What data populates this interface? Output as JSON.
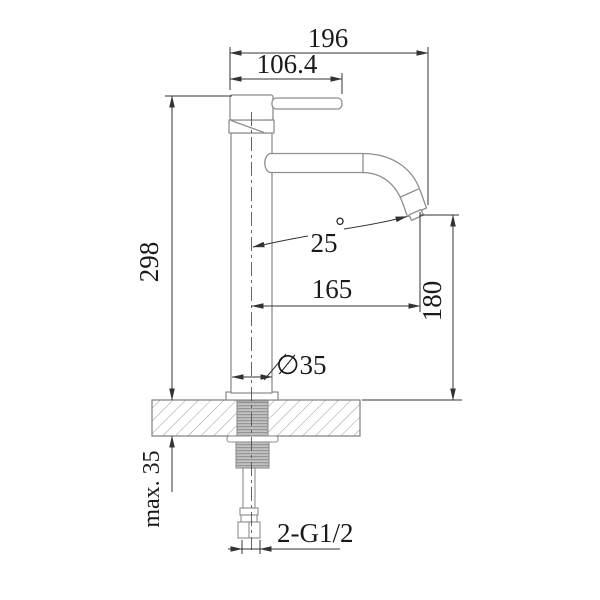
{
  "meta": {
    "type": "engineering-dimension-drawing",
    "subject": "tall single-lever basin mixer tap, side elevation with installation dimensions"
  },
  "colors": {
    "background": "#ffffff",
    "dimension_line": "#333333",
    "outline": "#8e8e8e",
    "hatch": "#9a9a9a",
    "thread_fill": "#c3c3c3",
    "text": "#1a1a1a"
  },
  "dimensions": {
    "overall_width": "196",
    "handle_reach": "106.4",
    "height_to_top": "298",
    "spout_angle_value": "25",
    "degree_symbol": "°",
    "spout_reach": "165",
    "outlet_height": "180",
    "body_diameter": "∅35",
    "max_deck_thickness": "max. 35",
    "inlet_thread": "2-G1/2"
  }
}
